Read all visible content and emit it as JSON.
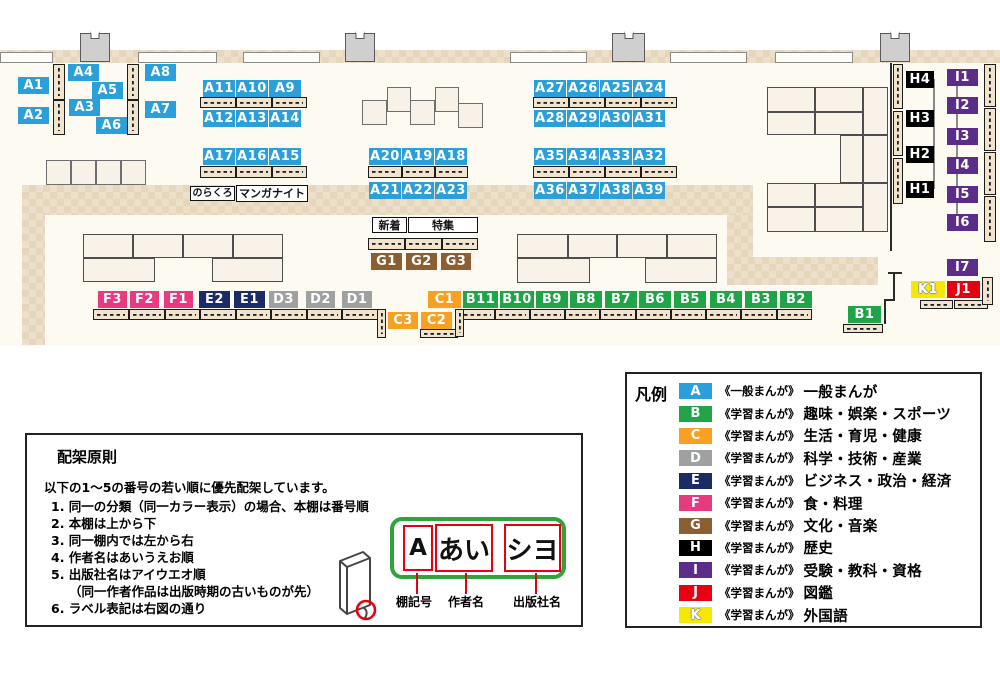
{
  "map": {
    "colors": {
      "A": "#2B9FD9",
      "B": "#1FA447",
      "C": "#F7A021",
      "D": "#9FA0A0",
      "E": "#1B2B66",
      "F": "#E73A7F",
      "G": "#8B5E34",
      "H": "#000000",
      "I": "#5B2D88",
      "J": "#E60012",
      "K": "#F6E800"
    },
    "labels": [
      {
        "id": "A1",
        "g": "A",
        "x": 18,
        "y": 77,
        "w": 31
      },
      {
        "id": "A2",
        "g": "A",
        "x": 18,
        "y": 107,
        "w": 31
      },
      {
        "id": "A4",
        "g": "A",
        "x": 68,
        "y": 64,
        "w": 31
      },
      {
        "id": "A5",
        "g": "A",
        "x": 92,
        "y": 82,
        "w": 31
      },
      {
        "id": "A3",
        "g": "A",
        "x": 69,
        "y": 99,
        "w": 31
      },
      {
        "id": "A6",
        "g": "A",
        "x": 96,
        "y": 117,
        "w": 31
      },
      {
        "id": "A8",
        "g": "A",
        "x": 145,
        "y": 64,
        "w": 31
      },
      {
        "id": "A7",
        "g": "A",
        "x": 145,
        "y": 101,
        "w": 31
      },
      {
        "id": "A11",
        "g": "A",
        "x": 203,
        "y": 80,
        "w": 32
      },
      {
        "id": "A10",
        "g": "A",
        "x": 236,
        "y": 80,
        "w": 32
      },
      {
        "id": "A9",
        "g": "A",
        "x": 269,
        "y": 80,
        "w": 32
      },
      {
        "id": "A12",
        "g": "A",
        "x": 203,
        "y": 110,
        "w": 32
      },
      {
        "id": "A13",
        "g": "A",
        "x": 236,
        "y": 110,
        "w": 32
      },
      {
        "id": "A14",
        "g": "A",
        "x": 269,
        "y": 110,
        "w": 32
      },
      {
        "id": "A17",
        "g": "A",
        "x": 203,
        "y": 148,
        "w": 32
      },
      {
        "id": "A16",
        "g": "A",
        "x": 236,
        "y": 148,
        "w": 32
      },
      {
        "id": "A15",
        "g": "A",
        "x": 269,
        "y": 148,
        "w": 32
      },
      {
        "id": "A20",
        "g": "A",
        "x": 369,
        "y": 148,
        "w": 32
      },
      {
        "id": "A19",
        "g": "A",
        "x": 402,
        "y": 148,
        "w": 32
      },
      {
        "id": "A18",
        "g": "A",
        "x": 435,
        "y": 148,
        "w": 32
      },
      {
        "id": "A21",
        "g": "A",
        "x": 369,
        "y": 182,
        "w": 32
      },
      {
        "id": "A22",
        "g": "A",
        "x": 402,
        "y": 182,
        "w": 32
      },
      {
        "id": "A23",
        "g": "A",
        "x": 435,
        "y": 182,
        "w": 32
      },
      {
        "id": "A27",
        "g": "A",
        "x": 534,
        "y": 80,
        "w": 32
      },
      {
        "id": "A26",
        "g": "A",
        "x": 567,
        "y": 80,
        "w": 32
      },
      {
        "id": "A25",
        "g": "A",
        "x": 600,
        "y": 80,
        "w": 32
      },
      {
        "id": "A24",
        "g": "A",
        "x": 633,
        "y": 80,
        "w": 32
      },
      {
        "id": "A28",
        "g": "A",
        "x": 534,
        "y": 110,
        "w": 32
      },
      {
        "id": "A29",
        "g": "A",
        "x": 567,
        "y": 110,
        "w": 32
      },
      {
        "id": "A30",
        "g": "A",
        "x": 600,
        "y": 110,
        "w": 32
      },
      {
        "id": "A31",
        "g": "A",
        "x": 633,
        "y": 110,
        "w": 32
      },
      {
        "id": "A35",
        "g": "A",
        "x": 534,
        "y": 148,
        "w": 32
      },
      {
        "id": "A34",
        "g": "A",
        "x": 567,
        "y": 148,
        "w": 32
      },
      {
        "id": "A33",
        "g": "A",
        "x": 600,
        "y": 148,
        "w": 32
      },
      {
        "id": "A32",
        "g": "A",
        "x": 633,
        "y": 148,
        "w": 32
      },
      {
        "id": "A36",
        "g": "A",
        "x": 534,
        "y": 182,
        "w": 32
      },
      {
        "id": "A37",
        "g": "A",
        "x": 567,
        "y": 182,
        "w": 32
      },
      {
        "id": "A38",
        "g": "A",
        "x": 600,
        "y": 182,
        "w": 32
      },
      {
        "id": "A39",
        "g": "A",
        "x": 633,
        "y": 182,
        "w": 32
      },
      {
        "id": "F3",
        "g": "F",
        "x": 98,
        "y": 291,
        "w": 29
      },
      {
        "id": "F2",
        "g": "F",
        "x": 130,
        "y": 291,
        "w": 29
      },
      {
        "id": "F1",
        "g": "F",
        "x": 164,
        "y": 291,
        "w": 29
      },
      {
        "id": "E2",
        "g": "E",
        "x": 199,
        "y": 291,
        "w": 31
      },
      {
        "id": "E1",
        "g": "E",
        "x": 234,
        "y": 291,
        "w": 31
      },
      {
        "id": "D3",
        "g": "D",
        "x": 269,
        "y": 291,
        "w": 29
      },
      {
        "id": "D2",
        "g": "D",
        "x": 306,
        "y": 291,
        "w": 29
      },
      {
        "id": "D1",
        "g": "D",
        "x": 342,
        "y": 291,
        "w": 30
      },
      {
        "id": "C1",
        "g": "C",
        "x": 428,
        "y": 291,
        "w": 33
      },
      {
        "id": "C3",
        "g": "C",
        "x": 388,
        "y": 312,
        "w": 30
      },
      {
        "id": "C2",
        "g": "C",
        "x": 421,
        "y": 312,
        "w": 31
      },
      {
        "id": "B11",
        "g": "B",
        "x": 463,
        "y": 291,
        "w": 35
      },
      {
        "id": "B10",
        "g": "B",
        "x": 500,
        "y": 291,
        "w": 34
      },
      {
        "id": "B9",
        "g": "B",
        "x": 536,
        "y": 291,
        "w": 32
      },
      {
        "id": "B8",
        "g": "B",
        "x": 570,
        "y": 291,
        "w": 32
      },
      {
        "id": "B7",
        "g": "B",
        "x": 605,
        "y": 291,
        "w": 32
      },
      {
        "id": "B6",
        "g": "B",
        "x": 639,
        "y": 291,
        "w": 32
      },
      {
        "id": "B5",
        "g": "B",
        "x": 674,
        "y": 291,
        "w": 32
      },
      {
        "id": "B4",
        "g": "B",
        "x": 710,
        "y": 291,
        "w": 32
      },
      {
        "id": "B3",
        "g": "B",
        "x": 745,
        "y": 291,
        "w": 32
      },
      {
        "id": "B2",
        "g": "B",
        "x": 780,
        "y": 291,
        "w": 32
      },
      {
        "id": "B1",
        "g": "B",
        "x": 848,
        "y": 306,
        "w": 33
      },
      {
        "id": "G1",
        "g": "G",
        "x": 371,
        "y": 253,
        "w": 31
      },
      {
        "id": "G2",
        "g": "G",
        "x": 406,
        "y": 253,
        "w": 31
      },
      {
        "id": "G3",
        "g": "G",
        "x": 441,
        "y": 253,
        "w": 30
      },
      {
        "id": "H4",
        "g": "H",
        "x": 906,
        "y": 71,
        "w": 28
      },
      {
        "id": "H3",
        "g": "H",
        "x": 906,
        "y": 110,
        "w": 28
      },
      {
        "id": "H2",
        "g": "H",
        "x": 906,
        "y": 146,
        "w": 28
      },
      {
        "id": "H1",
        "g": "H",
        "x": 906,
        "y": 181,
        "w": 28
      },
      {
        "id": "I1",
        "g": "I",
        "x": 947,
        "y": 69,
        "w": 31
      },
      {
        "id": "I2",
        "g": "I",
        "x": 947,
        "y": 97,
        "w": 31
      },
      {
        "id": "I3",
        "g": "I",
        "x": 947,
        "y": 128,
        "w": 31
      },
      {
        "id": "I4",
        "g": "I",
        "x": 947,
        "y": 157,
        "w": 31
      },
      {
        "id": "I5",
        "g": "I",
        "x": 947,
        "y": 186,
        "w": 31
      },
      {
        "id": "I6",
        "g": "I",
        "x": 947,
        "y": 214,
        "w": 31
      },
      {
        "id": "I7",
        "g": "I",
        "x": 947,
        "y": 259,
        "w": 31
      },
      {
        "id": "K1",
        "g": "K",
        "x": 911,
        "y": 281,
        "w": 34
      },
      {
        "id": "J1",
        "g": "J",
        "x": 947,
        "y": 281,
        "w": 33
      }
    ],
    "text_boxes": [
      {
        "text": "のらくろ",
        "x": 190,
        "y": 186,
        "w": 45,
        "h": 15,
        "fs": 10
      },
      {
        "text": "マンガナイト",
        "x": 236,
        "y": 185,
        "w": 72,
        "h": 17,
        "fs": 11
      },
      {
        "text": "新着",
        "x": 372,
        "y": 217,
        "w": 35,
        "h": 16,
        "fs": 11
      },
      {
        "text": "特集",
        "x": 408,
        "y": 217,
        "w": 70,
        "h": 16,
        "fs": 11
      }
    ]
  },
  "legend": {
    "title": "凡例",
    "rows": [
      {
        "code": "A",
        "type": "《一般まんが》",
        "category": "一般まんが"
      },
      {
        "code": "B",
        "type": "《学習まんが》",
        "category": "趣味・娯楽・スポーツ"
      },
      {
        "code": "C",
        "type": "《学習まんが》",
        "category": "生活・育児・健康"
      },
      {
        "code": "D",
        "type": "《学習まんが》",
        "category": "科学・技術・産業"
      },
      {
        "code": "E",
        "type": "《学習まんが》",
        "category": "ビジネス・政治・経済"
      },
      {
        "code": "F",
        "type": "《学習まんが》",
        "category": "食・料理"
      },
      {
        "code": "G",
        "type": "《学習まんが》",
        "category": "文化・音楽"
      },
      {
        "code": "H",
        "type": "《学習まんが》",
        "category": "歴史"
      },
      {
        "code": "I",
        "type": "《学習まんが》",
        "category": "受験・教科・資格"
      },
      {
        "code": "J",
        "type": "《学習まんが》",
        "category": "図鑑"
      },
      {
        "code": "K",
        "type": "《学習まんが》",
        "category": "外国語"
      }
    ]
  },
  "principles": {
    "title": "配架原則",
    "intro": "以下の1～5の番号の若い順に優先配架しています。",
    "lines": [
      {
        "t": "1. 同一の分類（同一カラー表示）の場合、本棚は番号順",
        "indent": false
      },
      {
        "t": "2. 本棚は上から下",
        "indent": false
      },
      {
        "t": "3. 同一棚内では左から右",
        "indent": false
      },
      {
        "t": "4. 作者名はあいうえお順",
        "indent": false
      },
      {
        "t": "5. 出版社名はアイウエオ順",
        "indent": false
      },
      {
        "t": "（同一作者作品は出版時期の古いものが先）",
        "indent": true
      },
      {
        "t": "6. ラベル表記は右図の通り",
        "indent": false
      }
    ]
  },
  "label_diagram": {
    "segments": [
      {
        "text": "A",
        "caption": "棚記号"
      },
      {
        "text": "あい",
        "caption": "作者名"
      },
      {
        "text": "シヨ",
        "caption": "出版社名"
      }
    ]
  }
}
